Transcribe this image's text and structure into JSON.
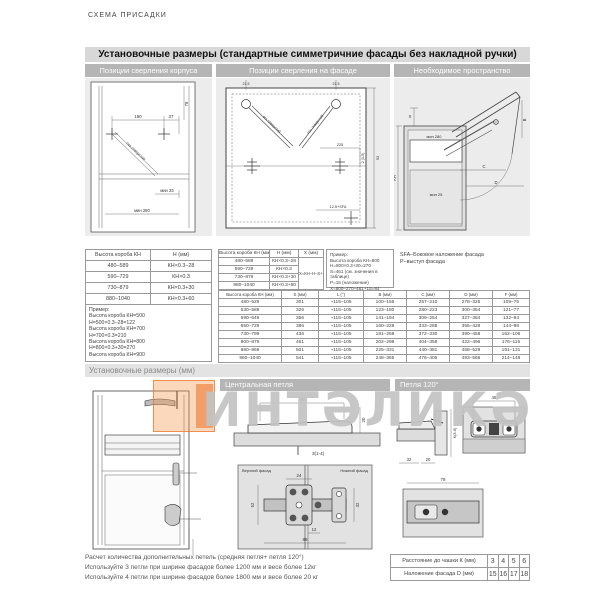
{
  "page": {
    "kicker": "СХЕМА ПРИСАДКИ"
  },
  "colors": {
    "accent_orange": "#e8833c",
    "bar_gray": "#b5b5b5",
    "header_gray": "#d8d8d8",
    "watermark_gray": "#c3c3c3"
  },
  "header": {
    "title": "Установочные размеры (стандартные симметричние фасады без накладной ручки)"
  },
  "panels": {
    "corpus": "Позиции сверления корпуса",
    "facade": "Позиции сверления на фасаде",
    "space": "Необходимое пространство"
  },
  "diagrams": {
    "corpus": {
      "dim_190": "190",
      "dim_37": "37",
      "dim_78": "78",
      "min25": "мин 25",
      "min280": "мин 280",
      "axis_note": "ось отверстий"
    },
    "facade": {
      "dim_215a": "21.5",
      "dim_215b": "21.5",
      "dim_225": "225",
      "dim_2_35": "2 (3-5)",
      "dim_125sfa": "12.5+SFA",
      "dim_93": "93",
      "axis_note_l": "ось отверстий",
      "axis_note_r": "ось отверстий"
    },
    "space": {
      "dim_x": "X",
      "dim_kh": "КН",
      "min280": "мин 280",
      "min25": "мин 25",
      "b": "B",
      "c": "C",
      "d": "D"
    },
    "central_side": {
      "dim_89": "89",
      "dim_20": "20",
      "dim_314": "3(1-4)"
    },
    "central_plan": {
      "upper": "Верхний фасад",
      "lower": "Нижний фасад",
      "dim_24": "24",
      "dim_52": "52",
      "dim_32": "32",
      "dim_12": "12",
      "dim_89": "89"
    },
    "hinge120": {
      "dim_45": "45",
      "dim_32": "32",
      "dim_20": "20",
      "dim_k": "К(3-6)",
      "dim_78": "78"
    }
  },
  "left_table": {
    "headers": [
      "Высота короба КН",
      "Н (мм)"
    ],
    "rows": [
      [
        "480–589",
        "КН×0.3–28"
      ],
      [
        "590–729",
        "КН×0.3"
      ],
      [
        "730–879",
        "КН×0.3+30"
      ],
      [
        "880–1040",
        "КН×0.3+60"
      ]
    ],
    "example": [
      "Пример:",
      "Высота короба КН=500",
      "Н=500×0.3–28=122",
      "Высота короба КН=700",
      "Н=700×0.3=210",
      "Высота короба КН=800",
      "Н=800×0.3+30=270",
      "Высота короба КН=900",
      "Н=900×0.3+60=330"
    ]
  },
  "mid_table": {
    "headers": [
      "Высота короба КН (мм)",
      "Н (мм)",
      "Х (мм)"
    ],
    "rows": [
      [
        "480–589",
        "КН×0.3–28"
      ],
      [
        "590–729",
        "КН×0.3"
      ],
      [
        "730–879",
        "КН×0.3+30"
      ],
      [
        "880–1040",
        "КН×0.3+60"
      ]
    ],
    "x_formula": "Х=КН–Н–S+Р",
    "example": [
      "Пример:",
      "Высота короба КН=800",
      "Н=800×0.3+30=270",
      "S=461 (см. значения в таблице)",
      "Р=15 (наложение)",
      "Х=800–270–461+15=84"
    ]
  },
  "legend": {
    "line1": "SFA–Боковое наложение фасада",
    "line2": "Р–выступ фасада"
  },
  "main_table": {
    "headers": [
      "Высота короба КН (мм)",
      "S (мм)",
      "L (°)",
      "В (мм)",
      "С (мм)",
      "D (мм)",
      "F (мм)"
    ],
    "rows": [
      [
        "480–529",
        "301",
        "~115–105",
        "100–156",
        "257–210",
        "278–325",
        "109–75"
      ],
      [
        "530–589",
        "326",
        "~115–105",
        "123–180",
        "280–223",
        "300–354",
        "121–77"
      ],
      [
        "590–649",
        "356",
        "~115–105",
        "141–194",
        "309–254",
        "327–384",
        "132–94"
      ],
      [
        "650–729",
        "386",
        "~115–105",
        "160–228",
        "333–288",
        "355–428",
        "144–98"
      ],
      [
        "730–799",
        "436",
        "~115–105",
        "181–258",
        "372–330",
        "390–458",
        "162–106"
      ],
      [
        "800–879",
        "461",
        "~115–105",
        "202–298",
        "404–358",
        "422–496",
        "176–115"
      ],
      [
        "880–959",
        "501",
        "~115–105",
        "225–331",
        "440–381",
        "458–529",
        "191–131"
      ],
      [
        "960–1040",
        "541",
        "~115–105",
        "248–365",
        "476–405",
        "493–566",
        "214–148"
      ]
    ]
  },
  "section2": {
    "title": "Установочные размеры (мм)",
    "central": "Центральная петля",
    "hinge120": "Петля 120°"
  },
  "watermark": {
    "text": "ИНТƏЛИКƏ"
  },
  "footer": {
    "lines": [
      "Расчет  количества дополнительных петель (средняя петля+ петля 120°)",
      "Используйте 3 петли при ширине фасадов более 1200 мм и весе более 12кг",
      "Используйте 4 петли при ширине фасадов более 1800 мм и весе более 20 кг"
    ],
    "table": {
      "rows": [
        [
          "Расстояние до чашки К (мм)",
          "3",
          "4",
          "5",
          "6"
        ],
        [
          "Наложение фасада D (мм)",
          "15",
          "16",
          "17",
          "18"
        ]
      ]
    }
  }
}
